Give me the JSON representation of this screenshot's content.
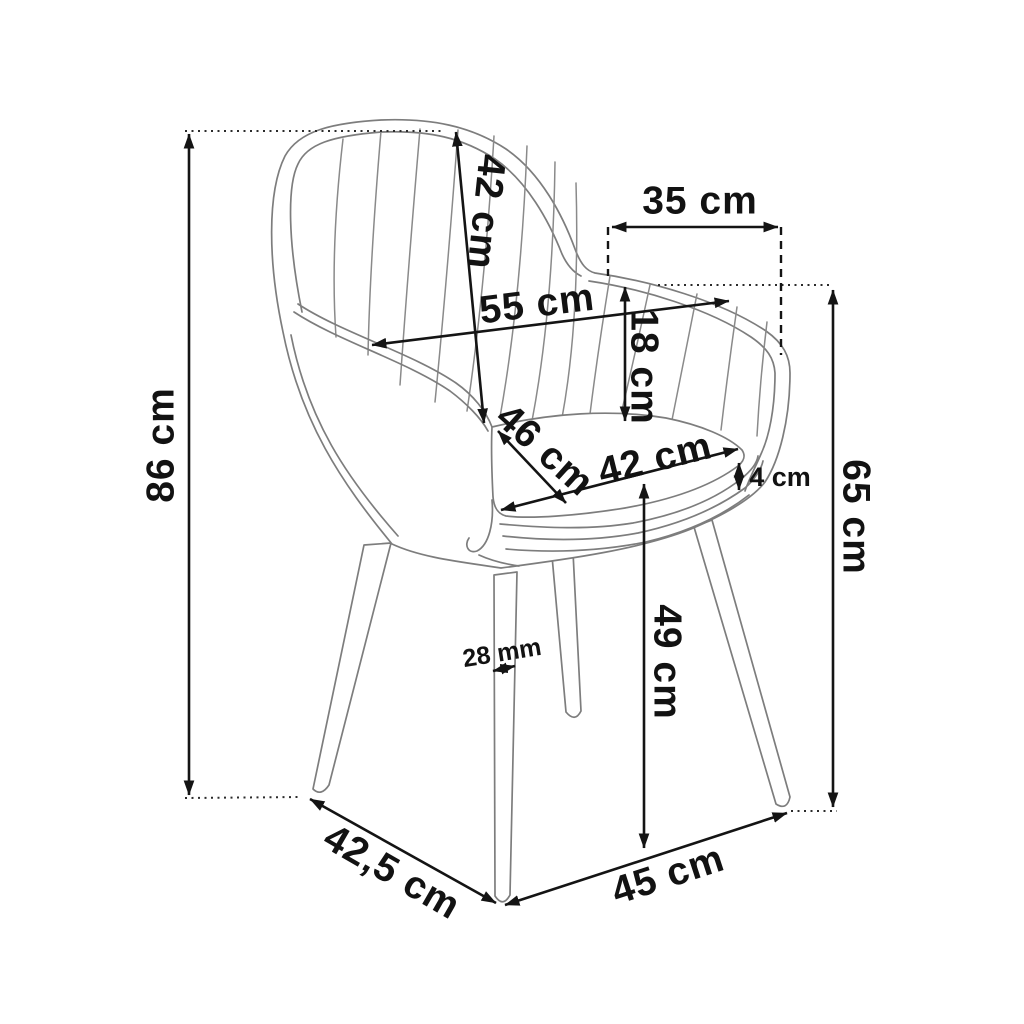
{
  "meta": {
    "description": "Upholstered armchair dimension diagram, three-quarter view line drawing",
    "background_color": "#ffffff",
    "drawing_line_color": "#7d7d7d",
    "dimension_line_color": "#141414",
    "text_color": "#121212"
  },
  "dimensions": {
    "overall_height": {
      "label": "86 cm"
    },
    "backrest_height": {
      "label": "42 cm"
    },
    "between_armrests": {
      "label": "35 cm"
    },
    "backrest_width": {
      "label": "55 cm"
    },
    "seat_to_armrest": {
      "label": "18 cm"
    },
    "armrest_height": {
      "label": "65 cm"
    },
    "seat_depth": {
      "label": "46 cm"
    },
    "seat_width": {
      "label": "42 cm"
    },
    "cushion_thickness": {
      "label": "4 cm"
    },
    "seat_height": {
      "label": "49 cm"
    },
    "leg_thickness": {
      "label": "28 mm"
    },
    "base_depth": {
      "label": "42,5 cm"
    },
    "base_width": {
      "label": "45 cm"
    }
  }
}
